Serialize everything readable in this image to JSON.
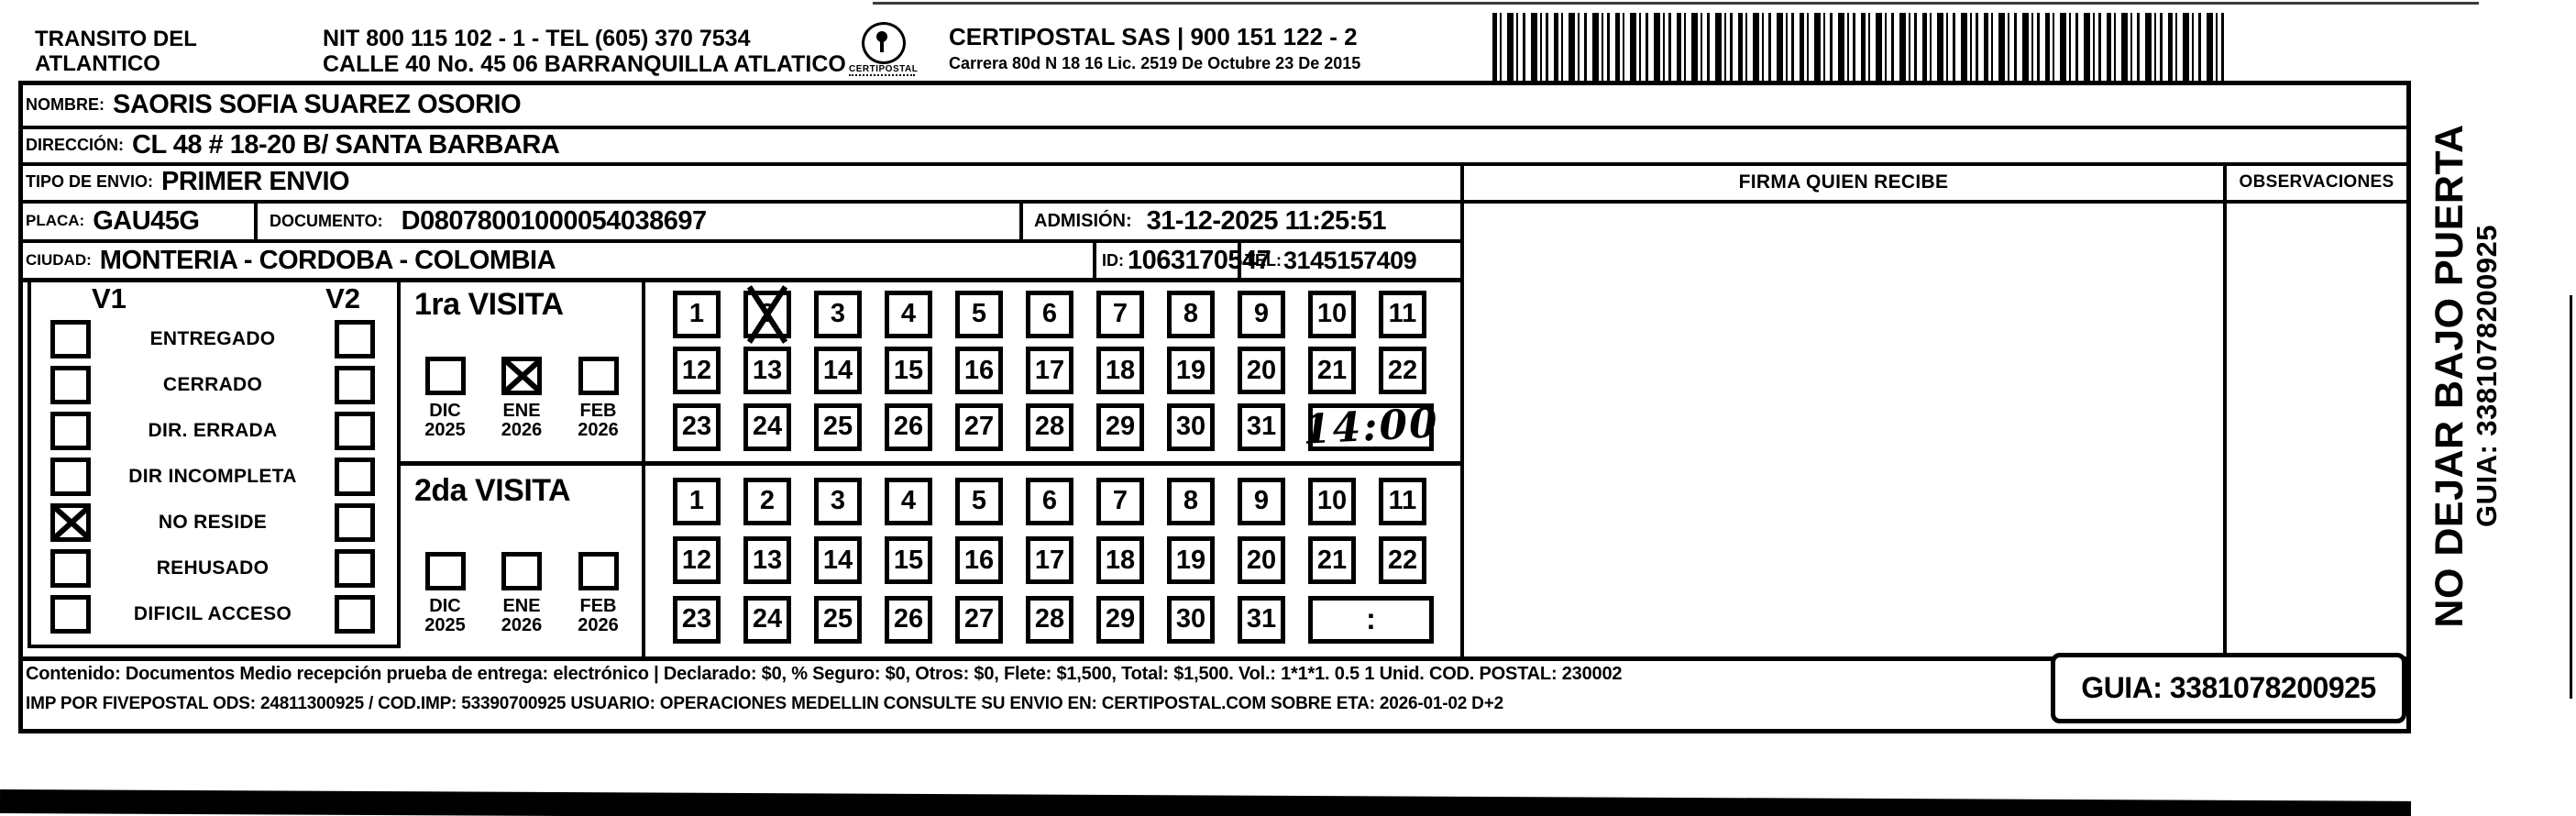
{
  "header": {
    "shipper_line1": "TRANSITO DEL",
    "shipper_line2": "ATLANTICO",
    "nit_line": "NIT 800 115 102 - 1 - TEL (605) 370 7534",
    "address_line": "CALLE 40 No. 45 06 BARRANQUILLA ATLATICO",
    "logo_caption": "CERTIPOSTAL",
    "operator_line1": "CERTIPOSTAL SAS | 900 151 122 - 2",
    "operator_line2": "Carrera 80d N 18 16  Lic. 2519 De Octubre 23 De 2015"
  },
  "shipment": {
    "nombre_label": "NOMBRE:",
    "nombre_value": "SAORIS SOFIA SUAREZ OSORIO",
    "direccion_label": "DIRECCIÓN:",
    "direccion_value": "CL 48 # 18-20 B/ SANTA BARBARA",
    "tipo_envio_label": "TIPO DE ENVIO:",
    "tipo_envio_value": "PRIMER ENVIO",
    "placa_label": "PLACA:",
    "placa_value": "GAU45G",
    "documento_label": "DOCUMENTO:",
    "documento_value": "D08078001000054038697",
    "admision_label": "ADMISIÓN:",
    "admision_value": "31-12-2025 11:25:51",
    "ciudad_label": "CIUDAD:",
    "ciudad_value": "MONTERIA - CORDOBA - COLOMBIA",
    "id_label": "ID:",
    "id_value": "1063170547",
    "tel_label": "TEL:",
    "tel_value": "3145157409"
  },
  "signature": {
    "firma_header": "FIRMA QUIEN RECIBE",
    "observaciones_header": "OBSERVACIONES"
  },
  "status_panel": {
    "v1_header": "V1",
    "v2_header": "V2",
    "rows": [
      {
        "label": "ENTREGADO",
        "v1_checked": false,
        "v2_checked": false
      },
      {
        "label": "CERRADO",
        "v1_checked": false,
        "v2_checked": false
      },
      {
        "label": "DIR. ERRADA",
        "v1_checked": false,
        "v2_checked": false
      },
      {
        "label": "DIR INCOMPLETA",
        "v1_checked": false,
        "v2_checked": false
      },
      {
        "label": "NO RESIDE",
        "v1_checked": true,
        "v2_checked": false
      },
      {
        "label": "REHUSADO",
        "v1_checked": false,
        "v2_checked": false
      },
      {
        "label": "DIFICIL ACCESO",
        "v1_checked": false,
        "v2_checked": false
      }
    ]
  },
  "visit1": {
    "title": "1ra VISITA",
    "months": [
      {
        "month": "DIC",
        "year": "2025",
        "checked": false
      },
      {
        "month": "ENE",
        "year": "2026",
        "checked": true
      },
      {
        "month": "FEB",
        "year": "2026",
        "checked": false
      }
    ],
    "days": [
      [
        "1",
        "2",
        "3",
        "4",
        "5",
        "6",
        "7",
        "8",
        "9",
        "10",
        "11"
      ],
      [
        "12",
        "13",
        "14",
        "15",
        "16",
        "17",
        "18",
        "19",
        "20",
        "21",
        "22"
      ],
      [
        "23",
        "24",
        "25",
        "26",
        "27",
        "28",
        "29",
        "30",
        "31"
      ]
    ],
    "marked_day": "2",
    "time_written": "14:00",
    "time_placeholder": ""
  },
  "visit2": {
    "title": "2da VISITA",
    "months": [
      {
        "month": "DIC",
        "year": "2025",
        "checked": false
      },
      {
        "month": "ENE",
        "year": "2026",
        "checked": false
      },
      {
        "month": "FEB",
        "year": "2026",
        "checked": false
      }
    ],
    "days": [
      [
        "1",
        "2",
        "3",
        "4",
        "5",
        "6",
        "7",
        "8",
        "9",
        "10",
        "11"
      ],
      [
        "12",
        "13",
        "14",
        "15",
        "16",
        "17",
        "18",
        "19",
        "20",
        "21",
        "22"
      ],
      [
        "23",
        "24",
        "25",
        "26",
        "27",
        "28",
        "29",
        "30",
        "31"
      ]
    ],
    "marked_day": "",
    "time_written": "",
    "time_placeholder": ":"
  },
  "side_note": {
    "warning": "NO DEJAR BAJO PUERTA",
    "guia": "GUIA: 3381078200925"
  },
  "footer": {
    "content_line": "Contenido: Documentos Medio recepción prueba de entrega: electrónico | Declarado: $0, % Seguro: $0, Otros: $0, Flete: $1,500, Total: $1,500. Vol.: 1*1*1. 0.5  1 Unid. COD. POSTAL: 230002",
    "imp_line": "IMP POR FIVEPOSTAL ODS: 24811300925 / COD.IMP: 53390700925 USUARIO: OPERACIONES MEDELLIN CONSULTE SU ENVIO EN: CERTIPOSTAL.COM SOBRE ETA: 2026-01-02 D+2",
    "guia_box": "GUIA: 3381078200925"
  }
}
